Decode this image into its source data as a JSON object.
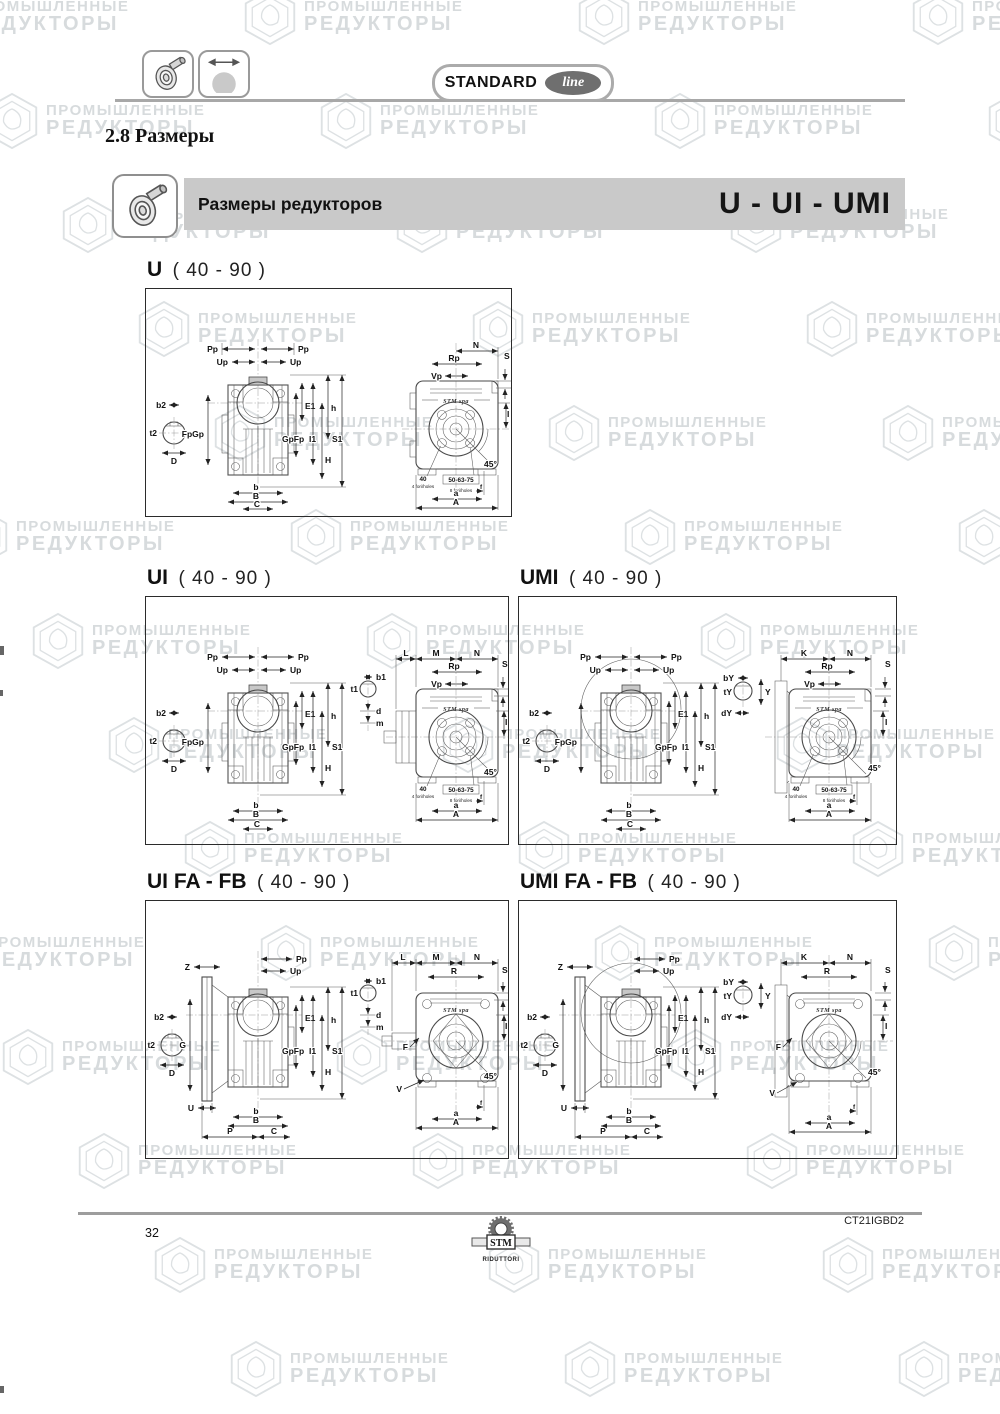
{
  "header": {
    "badge": {
      "standard": "STANDARD",
      "line": "line"
    }
  },
  "section_title": "2.8 Размеры",
  "banner": {
    "title": "Размеры редукторов",
    "models": "U - UI - UMI"
  },
  "watermark": {
    "line1": "ПРОМЫШЛЕННЫЕ",
    "line2": "РЕДУКТОРЫ"
  },
  "panels": [
    {
      "model": "U",
      "range": "( 40 - 90 )"
    },
    {
      "model": "UI",
      "range": "( 40 - 90 )"
    },
    {
      "model": "UMI",
      "range": "( 40 - 90 )"
    },
    {
      "model": "UI FA - FB",
      "range": "( 40 - 90 )"
    },
    {
      "model": "UMI FA - FB",
      "range": "( 40 - 90 )"
    }
  ],
  "dims": {
    "Pp": "Pp",
    "Up": "Up",
    "FpGp": "FpGp",
    "GpFp": "GpFp",
    "E1": "E1",
    "I1": "I1",
    "h": "h",
    "S1": "S1",
    "H": "H",
    "b": "b",
    "B": "B",
    "C": "C",
    "b2": "b2",
    "t2": "t2",
    "D": "D",
    "b1": "b1",
    "t1": "t1",
    "d": "d",
    "m": "m",
    "bY": "bY",
    "tY": "tY",
    "dY": "dY",
    "Y": "Y",
    "L": "L",
    "M": "M",
    "N": "N",
    "K": "K",
    "R": "R",
    "Rp": "Rp",
    "Vp": "Vp",
    "S": "S",
    "I": "I",
    "f": "f",
    "a": "a",
    "A": "A",
    "Z": "Z",
    "G": "G",
    "U": "U",
    "P": "P",
    "F": "F",
    "V": "V",
    "deg45": "45°",
    "stm_spa": "STM spa",
    "holes40": "40",
    "holes40_sub": "4 fori/holes",
    "holes5063": "50-63-75",
    "holes5063_sub": "8 fori/holes"
  },
  "footer": {
    "page_number": "32",
    "doc_code": "CT21IGBD2",
    "logo_text": "STM",
    "logo_sub": "RIDUTTORI"
  }
}
